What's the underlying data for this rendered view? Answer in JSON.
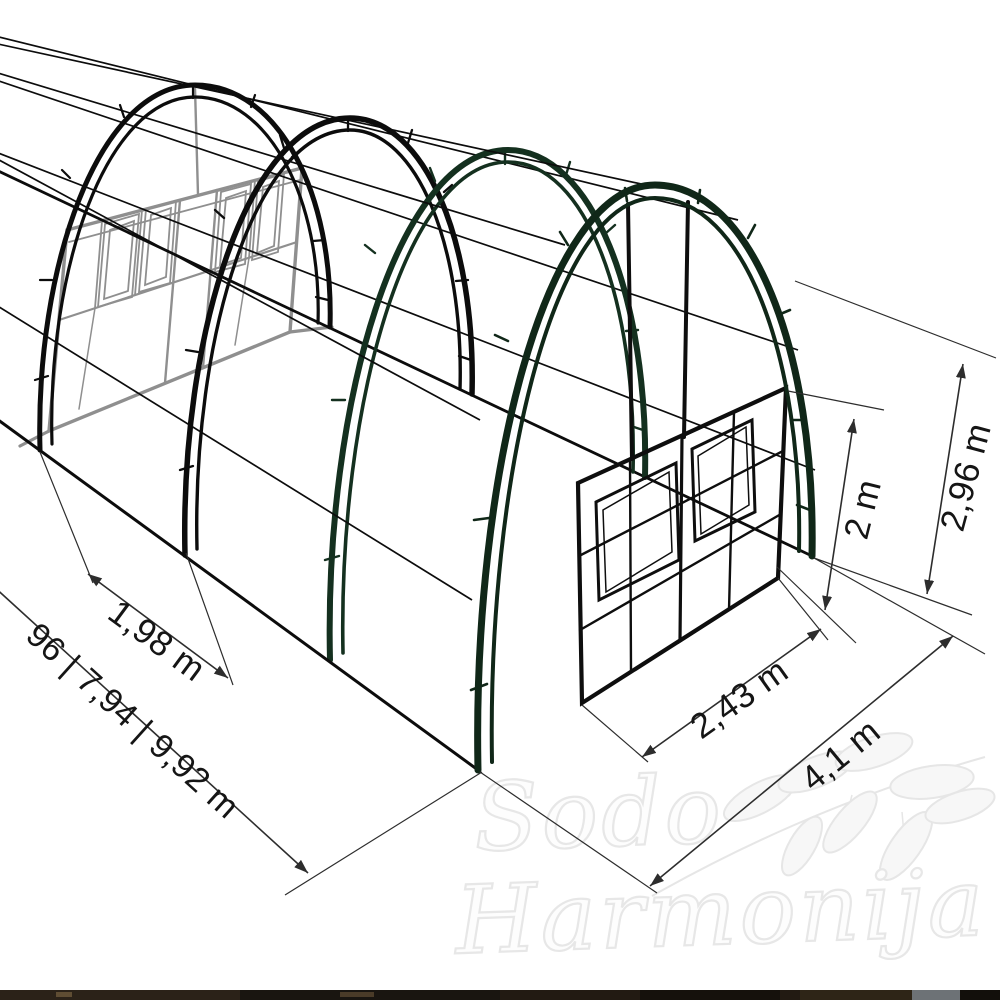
{
  "diagram": {
    "dimension_labels": {
      "arch_spacing": "1,98 m",
      "length_options": "96 | 7,94 | 9,92 m",
      "door_section_width": "2,43 m",
      "total_width": "4,1 m",
      "door_height": "2 m",
      "total_height": "2,96 m"
    },
    "colors": {
      "background": "#ffffff",
      "frame_black": "#0c0c0c",
      "frame_dark_green": "#14301f",
      "rear_wall_gray": "#8f8f8f",
      "dimension_line": "#2d2d2d",
      "label_text": "#151515",
      "watermark": "#e7e7e7",
      "bottom_strip": "#221a12"
    }
  },
  "watermark": {
    "line1": "Sodo",
    "line2": "Harmonija"
  }
}
